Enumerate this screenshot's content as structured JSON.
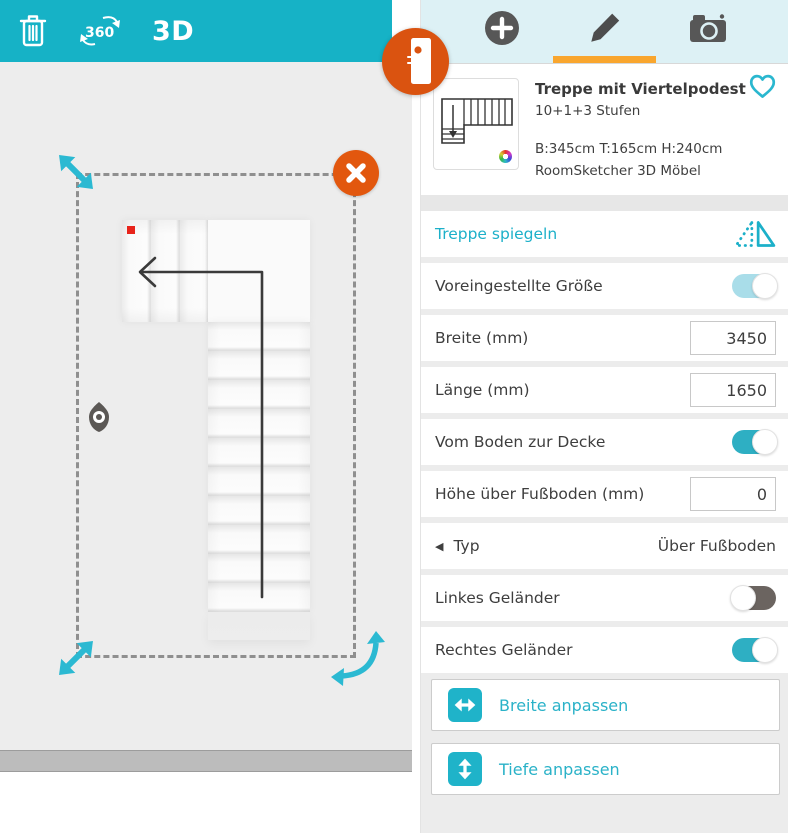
{
  "colors": {
    "toolbar_teal": "#16b2c6",
    "accent_cyan": "#1cb0c9",
    "handle_cyan": "#2bb9d2",
    "orange": "#da5310",
    "tab_underline": "#f9a62e",
    "toggle_on": "#2eafc3",
    "toggle_off": "#6b6460"
  },
  "toolbar": {
    "view3d_label": "3D",
    "rotate_label": "360"
  },
  "canvas": {
    "selected_object": "Treppe mit Viertelpodest"
  },
  "panel": {
    "card": {
      "title": "Treppe mit Viertelpodest",
      "subtitle": "10+1+3 Stufen",
      "dimensions": "B:345cm T:165cm H:240cm",
      "source": "RoomSketcher 3D Möbel"
    },
    "rows": {
      "mirror": {
        "label": "Treppe spiegeln"
      },
      "preset": {
        "label": "Voreingestellte Größe",
        "state": "on"
      },
      "width": {
        "label": "Breite (mm)",
        "value": "3450"
      },
      "length": {
        "label": "Länge (mm)",
        "value": "1650"
      },
      "floor_to_ceiling": {
        "label": "Vom Boden zur Decke",
        "state": "on"
      },
      "height_above_floor": {
        "label": "Höhe über Fußboden (mm)",
        "value": "0"
      },
      "type": {
        "label": "Typ",
        "value": "Über Fußboden"
      },
      "left_railing": {
        "label": "Linkes Geländer",
        "state": "off"
      },
      "right_railing": {
        "label": "Rechtes Geländer",
        "state": "on"
      }
    },
    "buttons": {
      "adjust_width": "Breite anpassen",
      "adjust_depth": "Tiefe anpassen"
    }
  }
}
